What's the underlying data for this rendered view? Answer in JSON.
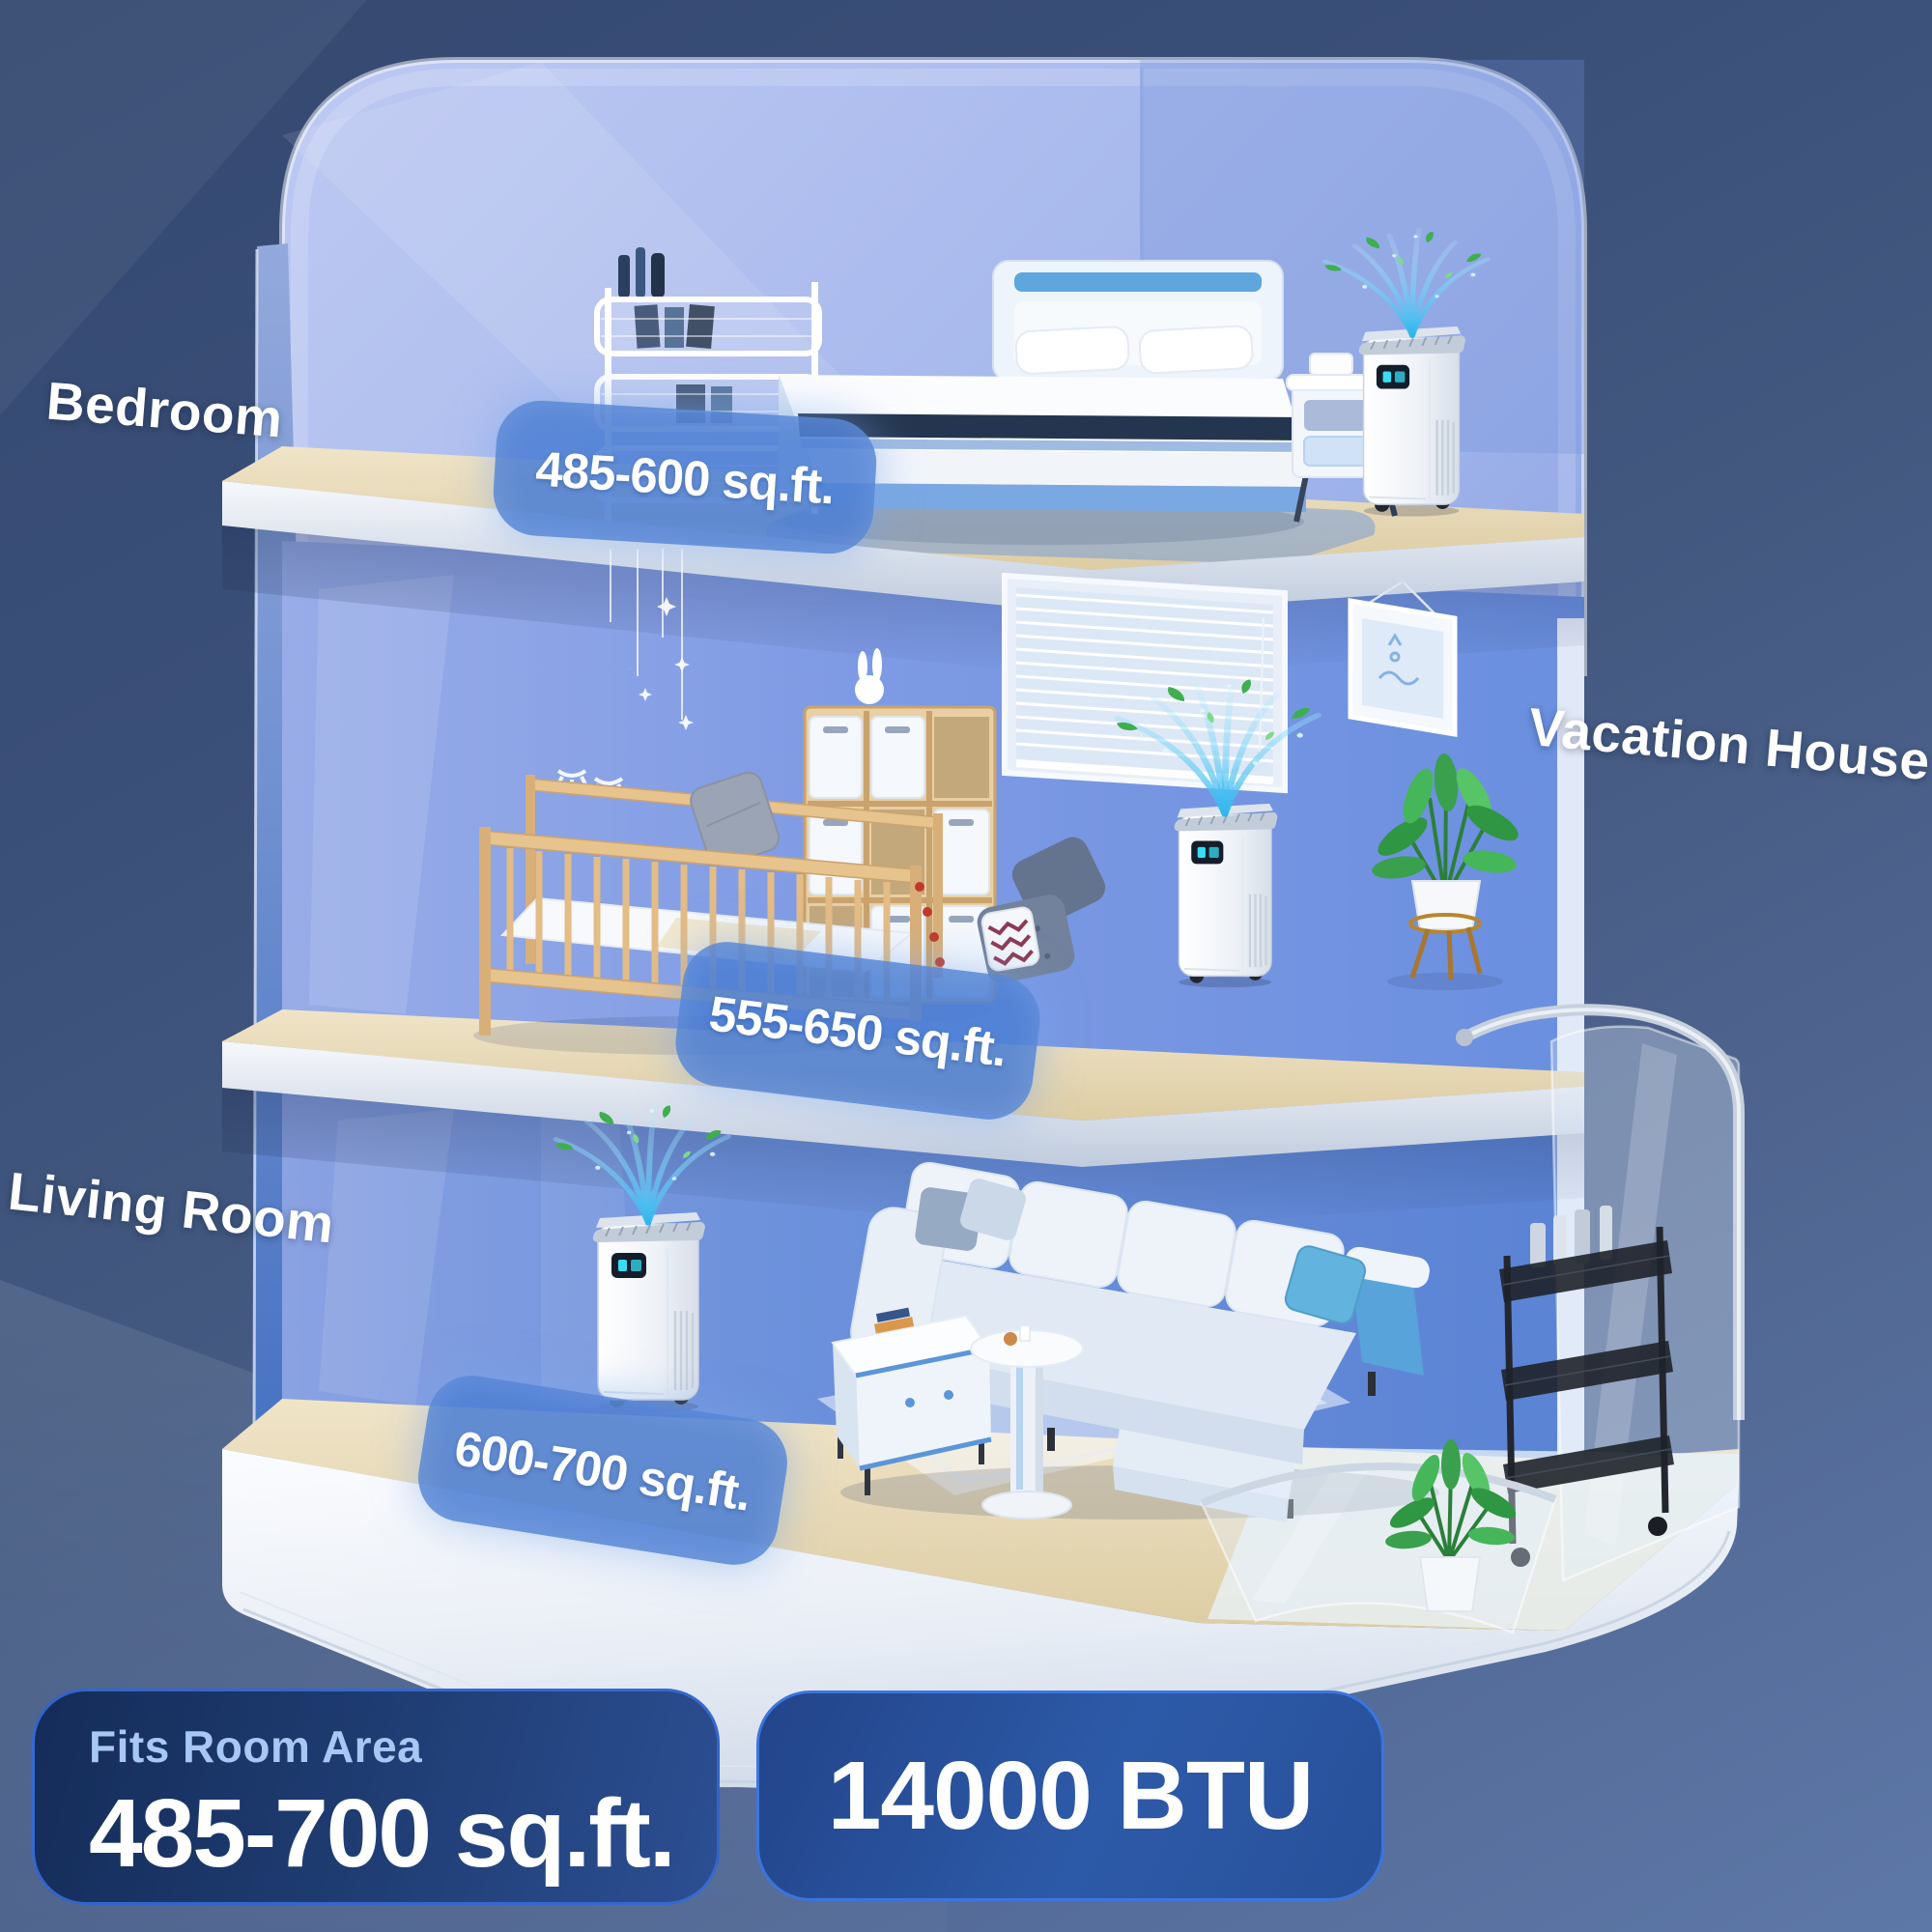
{
  "scene": {
    "room_labels": [
      {
        "id": "bedroom",
        "label": "Bedroom"
      },
      {
        "id": "vacation-house",
        "label": "Vacation House"
      },
      {
        "id": "living-room",
        "label": "Living Room"
      }
    ],
    "area_pills": [
      {
        "room": "bedroom",
        "text": "485-600 sq.ft."
      },
      {
        "room": "kids-room",
        "text": "555-650 sq.ft."
      },
      {
        "room": "living-room",
        "text": "600-700 sq.ft."
      }
    ]
  },
  "footer_badges": {
    "fits_room_area": {
      "label": "Fits Room Area",
      "value": "485-700 sq.ft."
    },
    "capacity": {
      "value": "14000 BTU"
    }
  },
  "icons": {
    "airflow": "cool-air-stream-arcs",
    "leaf": "fresh-air-leaf",
    "ac_unit": "portable-air-conditioner"
  },
  "colors": {
    "background_top": "#344870",
    "background_bottom": "#5d77a7",
    "wall_light": "#bdc9f2",
    "wall_mid": "#7e99e0",
    "wall_accent": "#4672c2",
    "floor_wood": "#e8dcc0",
    "pill_fill": "#4d80d4",
    "badge_dark": "#142c58",
    "badge_blue": "#2d5aa8",
    "badge_border": "#3a74dd",
    "badge_title_text": "#a9c7f4",
    "text": "#ffffff",
    "airflow": "#4fc6f4",
    "leaf": "#3fae4f"
  }
}
